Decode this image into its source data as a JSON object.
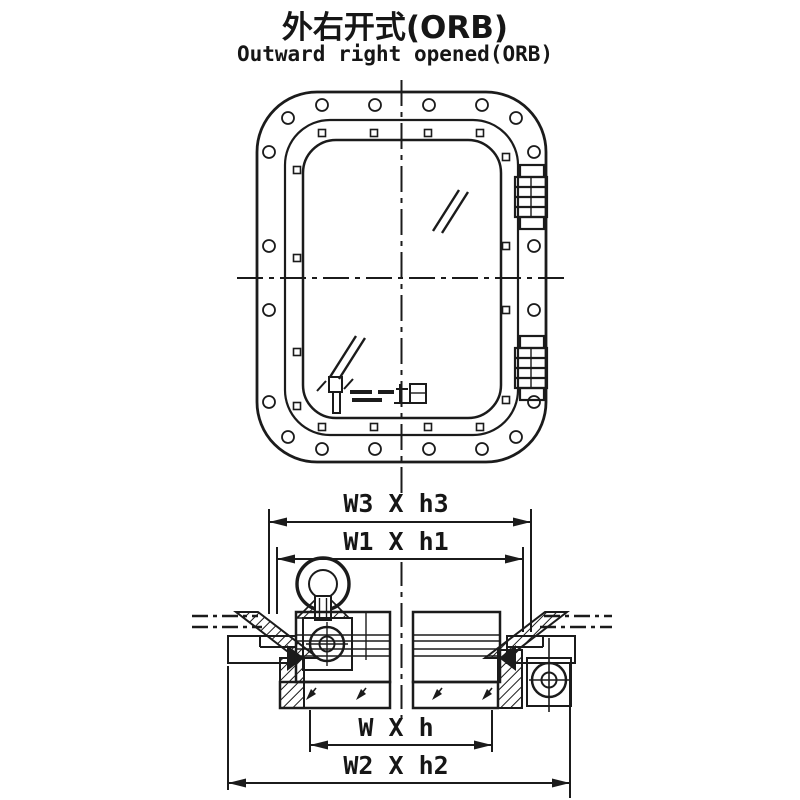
{
  "title": {
    "zh": "外右开式(ORB)",
    "en": "Outward right opened(ORB)"
  },
  "dimension_labels": {
    "w3h3": "W3 X h3",
    "w1h1": "W1 X h1",
    "wh": "W X h",
    "w2h2": "W2 X h2"
  },
  "colors": {
    "line": "#1b1b1b",
    "background": "#ffffff"
  }
}
